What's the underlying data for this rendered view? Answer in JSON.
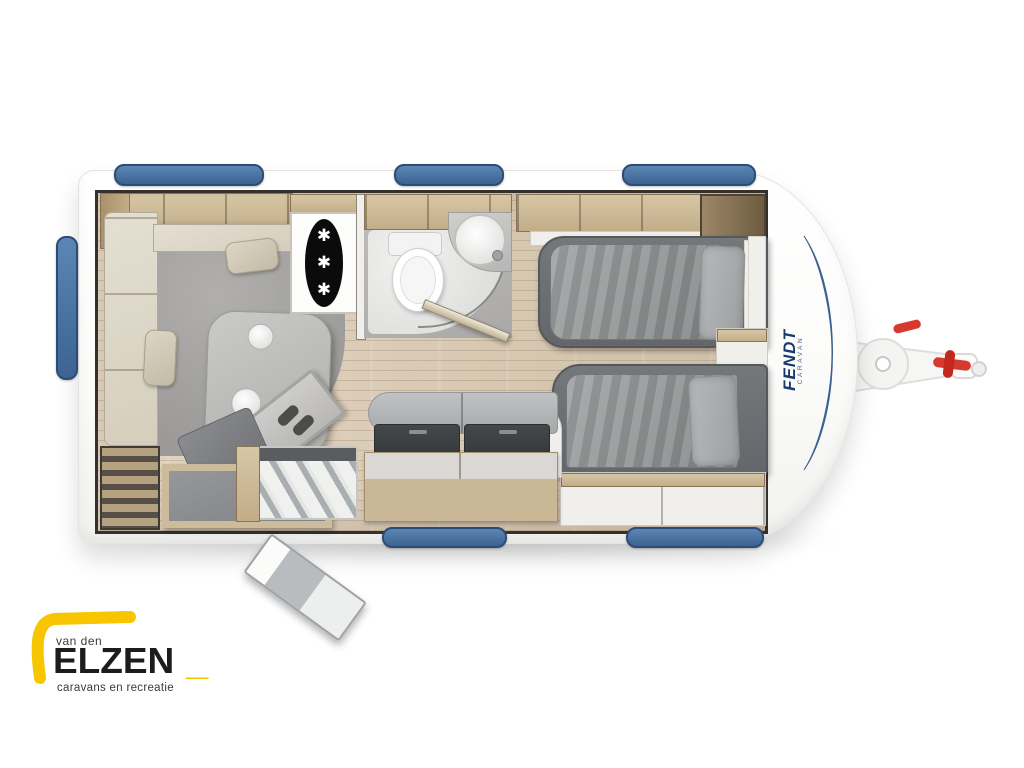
{
  "page": {
    "background": "#ffffff",
    "description_type": "caravan floor plan product image"
  },
  "logo": {
    "top_text": "van den",
    "name": "ELZEN",
    "mark": "_",
    "subtitle": "caravans en recreatie",
    "colors": {
      "accent": "#f7c600",
      "text": "#1d1d1b",
      "muted": "#3b3b3a"
    }
  },
  "caravan": {
    "brand": {
      "name": "FENDT",
      "sub": "CARAVAN",
      "color": "#173a6d"
    },
    "fridge": {
      "snowflake": "✱"
    },
    "colors": {
      "body": "#ffffff",
      "accent_blue": "#4a74a6",
      "window_blue": "#44688f",
      "floor_wood": "#decfbb",
      "cabinet_wood": "#cfbc9a",
      "carpet": "#a5a4a2",
      "upholstery": "#ded8ca",
      "bedding": "#8f9192",
      "kitchen_dark": "#3d4043",
      "plant_green": "#55a82e",
      "hitch_red": "#d63a2f"
    }
  }
}
